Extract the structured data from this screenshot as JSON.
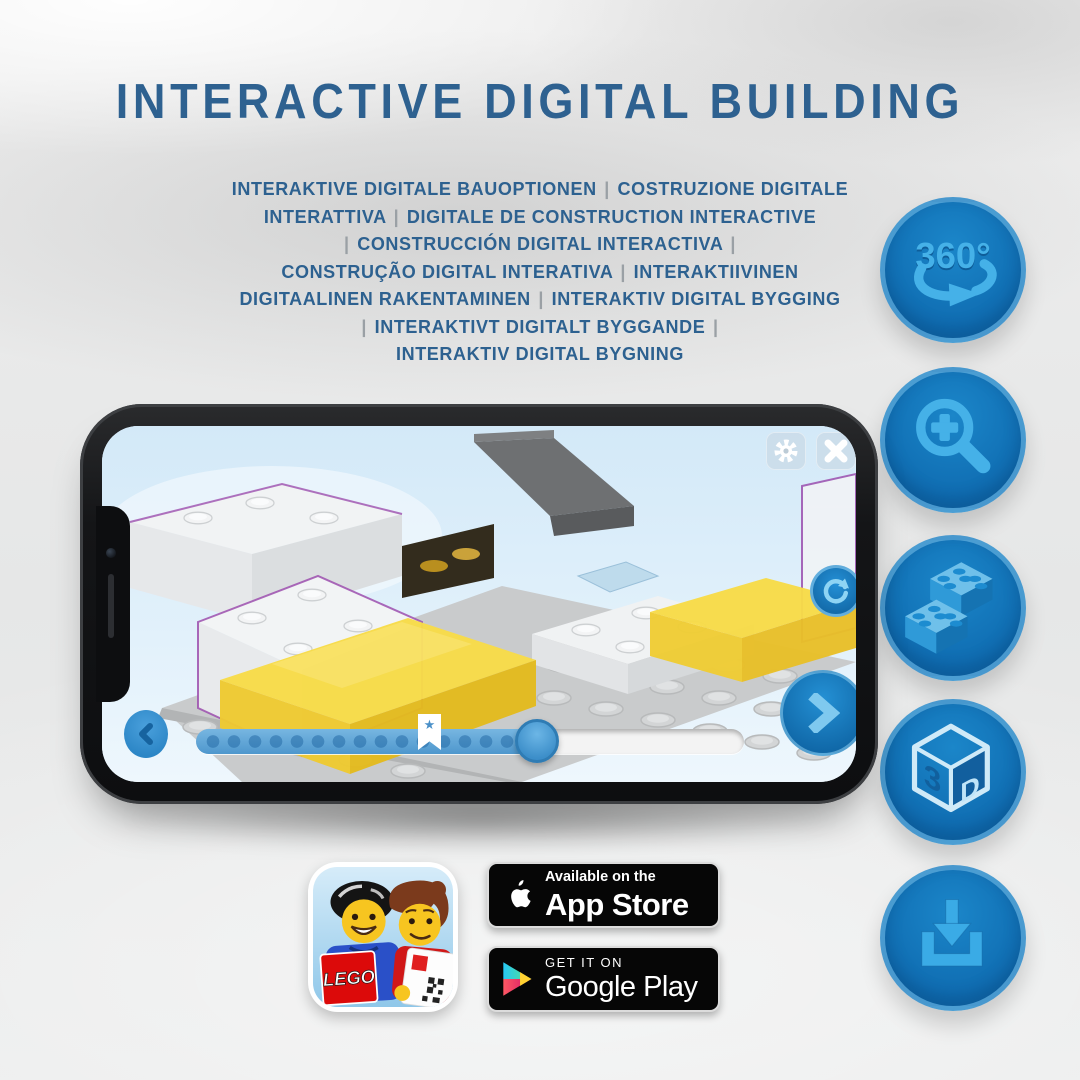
{
  "colors": {
    "title_text": "#2e6190",
    "separator_gray": "#9aa0a5",
    "icon_circle_blue": "#1173b8",
    "icon_glyph_blue": "#45b1e8",
    "screen_sky_blue": "#ddeefa",
    "brick_yellow": "#f8dc48",
    "ghost_outline_purple": "#9c4fae",
    "badge_black": "#060606"
  },
  "header": {
    "title": "INTERACTIVE DIGITAL BUILDING",
    "subtitle_lines": [
      "INTERAKTIVE DIGITALE BAUOPTIONEN | COSTRUZIONE DIGITALE",
      "INTERATTIVA | DIGITALE DE CONSTRUCTION INTERACTIVE",
      "| CONSTRUCCIÓN DIGITAL INTERACTIVA |",
      "CONSTRUÇÃO DIGITAL INTERATIVA | INTERAKTIIVINEN",
      "DIGITAALINEN RAKENTAMINEN | INTERAKTIV DIGITAL BYGGING",
      "| INTERAKTIVT DIGITALT BYGGANDE |",
      "INTERAKTIV DIGITAL BYGNING"
    ]
  },
  "features": {
    "rotation_label": "360°",
    "cube_left": "3",
    "cube_right": "D",
    "items": [
      "360-rotation",
      "zoom-in",
      "brick-building",
      "3d-view",
      "download"
    ]
  },
  "phone": {
    "slider": {
      "filled_percent": 64,
      "star_marker_percent": 43,
      "handle_percent": 62
    }
  },
  "store": {
    "app_icon_logo": "LEGO",
    "app_store": {
      "tagline": "Available on the",
      "name": "App Store"
    },
    "google_play": {
      "tagline": "GET IT ON",
      "name": "Google Play"
    }
  }
}
